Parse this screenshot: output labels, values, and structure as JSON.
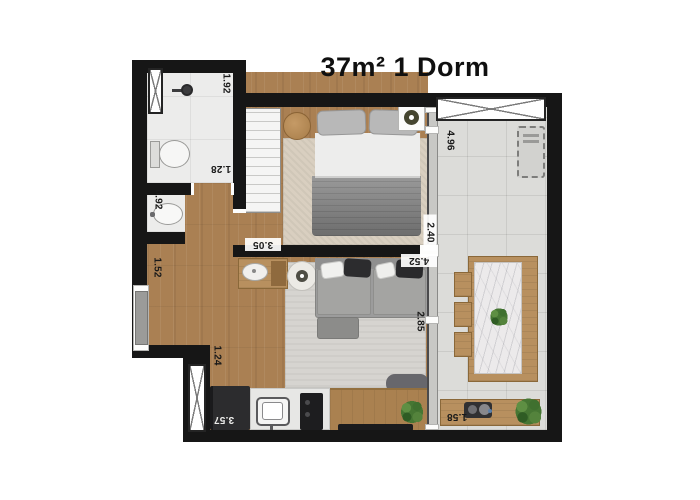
{
  "title": "37m² 1 Dorm",
  "dimensions": {
    "shower": "1.92",
    "bathroom": "1.28",
    "basin": "0.92",
    "hall": "1.52",
    "entry": "1.24",
    "bedroom_width": "3.05",
    "bedroom_depth": "2.40",
    "glass_span": "4.52",
    "living_depth": "2.85",
    "balcony_length": "4.96",
    "balcony_width": "1.58",
    "kitchen": "3.57"
  },
  "colors": {
    "wall": "#161616",
    "wood_floor": "#aa8053",
    "wood_furniture": "#b8905f",
    "tile_light": "#ececeb",
    "tile_balcony": "#dcdcd9",
    "rug_bedroom": "#d9cfc0",
    "rug_living": "#d6d4d0",
    "sofa_gray": "#9c9c9c",
    "appliance_dark": "#2c2c2e",
    "label_text": "#1a1a1a"
  }
}
